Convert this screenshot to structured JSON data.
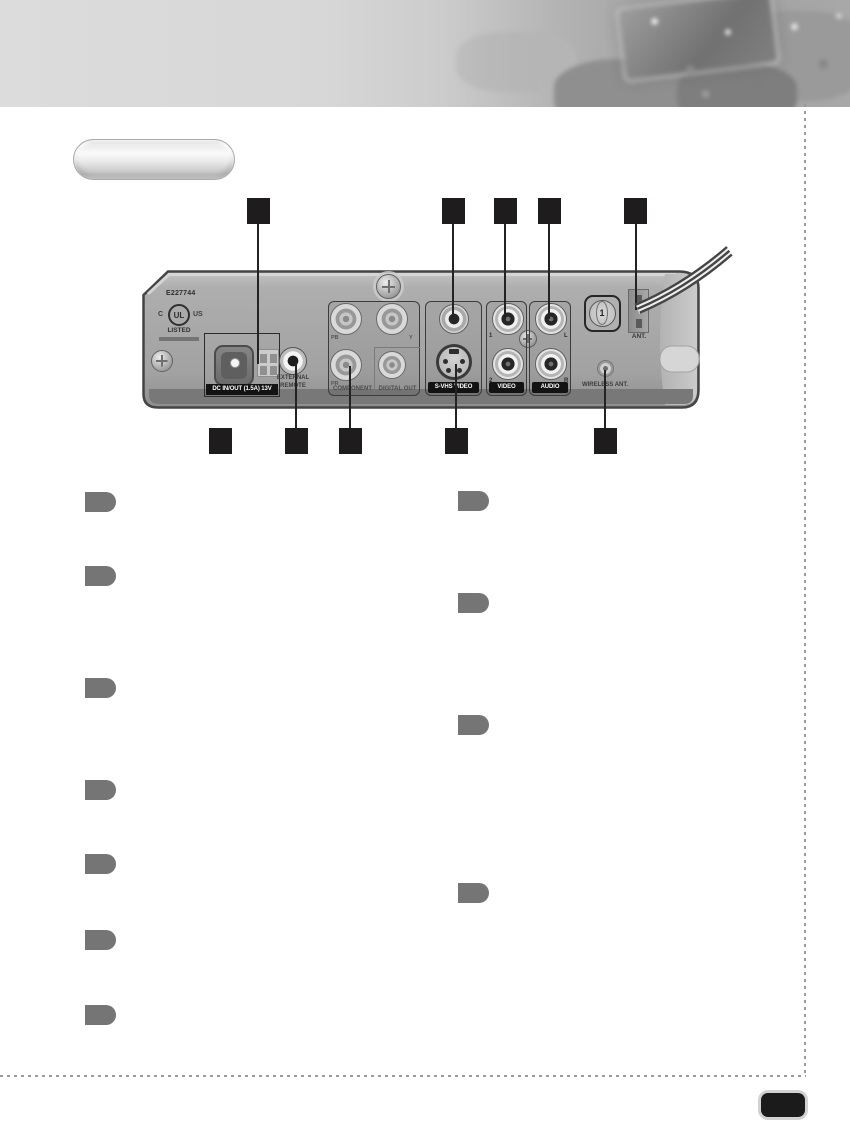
{
  "device_panel": {
    "model_number": "E227744",
    "ul_prefix": "C",
    "ul_mark": "UL",
    "ul_suffix": "US",
    "ul_listed": "LISTED",
    "dc_port_label": "DC IN/OUT (1.5A) 13V",
    "external_remote_line1": "EXTERNAL",
    "external_remote_line2": "REMOTE",
    "component_label": "COMPONENT",
    "digital_out_label": "DIGITAL OUT",
    "jack_pb": "PB",
    "jack_y": "Y",
    "jack_pr": "PR",
    "svhs_video_label": "S-VHS VIDEO",
    "video_label": "VIDEO",
    "video_jack_1": "1",
    "video_jack_2": "2",
    "audio_label": "AUDIO",
    "audio_jack_l": "L",
    "audio_jack_r": "R",
    "channel_dial": "1",
    "ant_label": "ANT.",
    "wireless_ant_label": "WIRELESS ANT."
  },
  "colors": {
    "callout_black": "#1f1c1d",
    "tab_gray": "#757575",
    "panel_gray": "#a2a2a2",
    "strip_black": "#131313"
  }
}
